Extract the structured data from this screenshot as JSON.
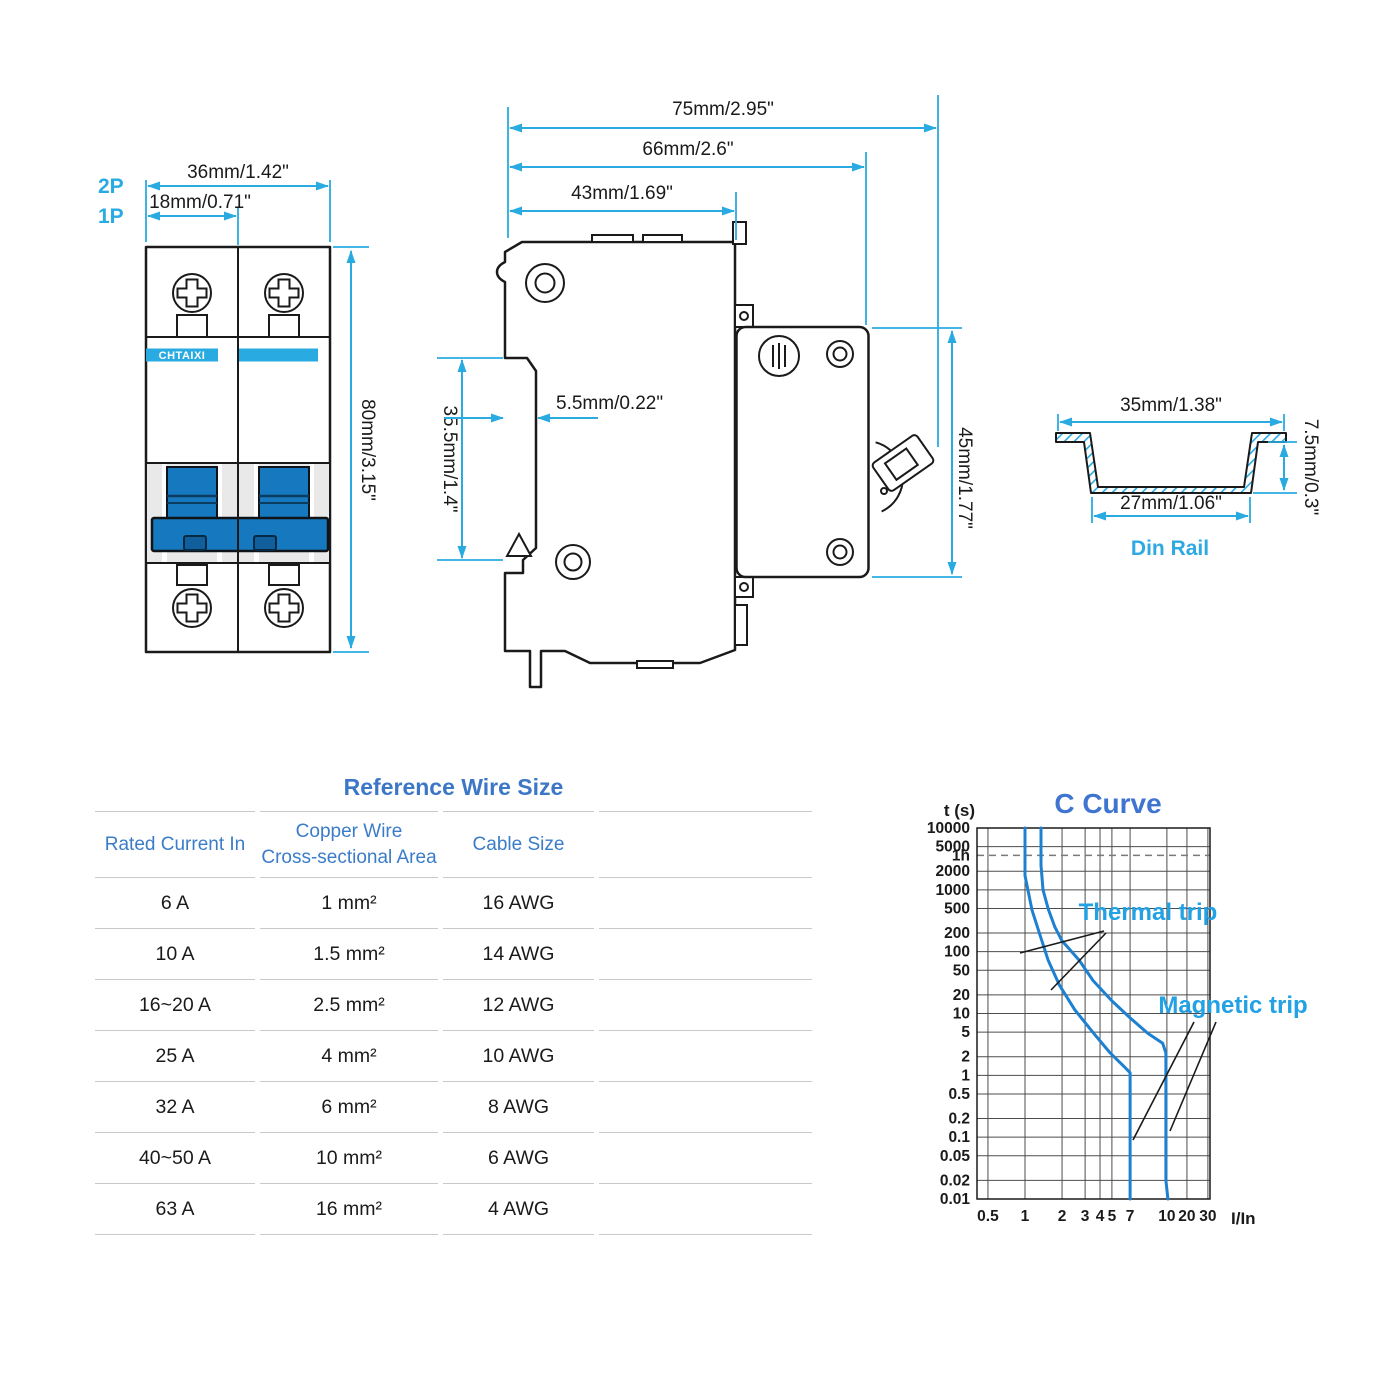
{
  "front_view": {
    "pole2_label": "2P",
    "pole1_label": "1P",
    "width_2p": "36mm/1.42\"",
    "width_1p": "18mm/0.71\"",
    "height": "80mm/3.15\"",
    "brand": "CHTAIXI"
  },
  "side_view": {
    "depth_total": "75mm/2.95\"",
    "depth_body": "66mm/2.6\"",
    "depth_front": "43mm/1.69\"",
    "rail_slot_height": "35.5mm/1.4\"",
    "rail_slot_depth": "5.5mm/0.22\"",
    "height_right": "45mm/1.77\""
  },
  "din_rail": {
    "label": "Din Rail",
    "width_outer": "35mm/1.38\"",
    "width_inner": "27mm/1.06\"",
    "depth": "7.5mm/0.3\""
  },
  "table": {
    "title": "Reference Wire Size",
    "col1": "Rated Current In",
    "col2_line1": "Copper Wire",
    "col2_line2": "Cross-sectional Area",
    "col3": "Cable Size",
    "rows": [
      [
        "6 A",
        "1 mm²",
        "16 AWG"
      ],
      [
        "10 A",
        "1.5 mm²",
        "14 AWG"
      ],
      [
        "16~20 A",
        "2.5 mm²",
        "12 AWG"
      ],
      [
        "25 A",
        "4 mm²",
        "10 AWG"
      ],
      [
        "32 A",
        "6 mm²",
        "8 AWG"
      ],
      [
        "40~50 A",
        "10 mm²",
        "6 AWG"
      ],
      [
        "63 A",
        "16 mm²",
        "4 AWG"
      ]
    ]
  },
  "chart_data": {
    "type": "line",
    "title": "C Curve",
    "ylabel": "t (s)",
    "xlabel": "I/In",
    "x_ticks": [
      0.5,
      1,
      2,
      3,
      4,
      5,
      7,
      10,
      20,
      30
    ],
    "y_ticks": [
      10000,
      5000,
      "1h",
      2000,
      1000,
      500,
      200,
      100,
      50,
      20,
      10,
      5,
      2,
      1,
      0.5,
      0.2,
      0.1,
      0.05,
      0.02,
      0.01
    ],
    "dashed_line_value_s": 3600,
    "grid": true,
    "annotations": [
      "Thermal trip",
      "Magnetic trip"
    ],
    "series": [
      {
        "name": "trip time lower limit",
        "points": [
          [
            1,
            10000
          ],
          [
            1,
            1700
          ],
          [
            1.14,
            470
          ],
          [
            1.32,
            190
          ],
          [
            1.54,
            73
          ],
          [
            1.9,
            29
          ],
          [
            2.5,
            11.5
          ],
          [
            3.6,
            4.6
          ],
          [
            4.8,
            2.35
          ],
          [
            6.4,
            1.33
          ],
          [
            7,
            1.1
          ],
          [
            7,
            0.01
          ]
        ]
      },
      {
        "name": "trip time upper limit",
        "points": [
          [
            1.35,
            10000
          ],
          [
            1.35,
            2500
          ],
          [
            1.4,
            1000
          ],
          [
            1.55,
            480
          ],
          [
            1.75,
            250
          ],
          [
            2,
            150
          ],
          [
            2.7,
            73
          ],
          [
            3.5,
            34
          ],
          [
            5,
            16
          ],
          [
            7,
            8.5
          ],
          [
            8.3,
            4.8
          ],
          [
            9.6,
            3.3
          ],
          [
            9.9,
            2.3
          ],
          [
            9.9,
            0.02
          ],
          [
            10.35,
            0.01
          ]
        ]
      }
    ]
  },
  "colors": {
    "dimension_cyan": "#29ABE2",
    "table_blue": "#3B76C7",
    "trip_label_blue": "#22A2E5",
    "curve_blue": "#1D80D0",
    "toggle_blue": "#1678BE",
    "brand_band_blue": "#29ABE2"
  }
}
